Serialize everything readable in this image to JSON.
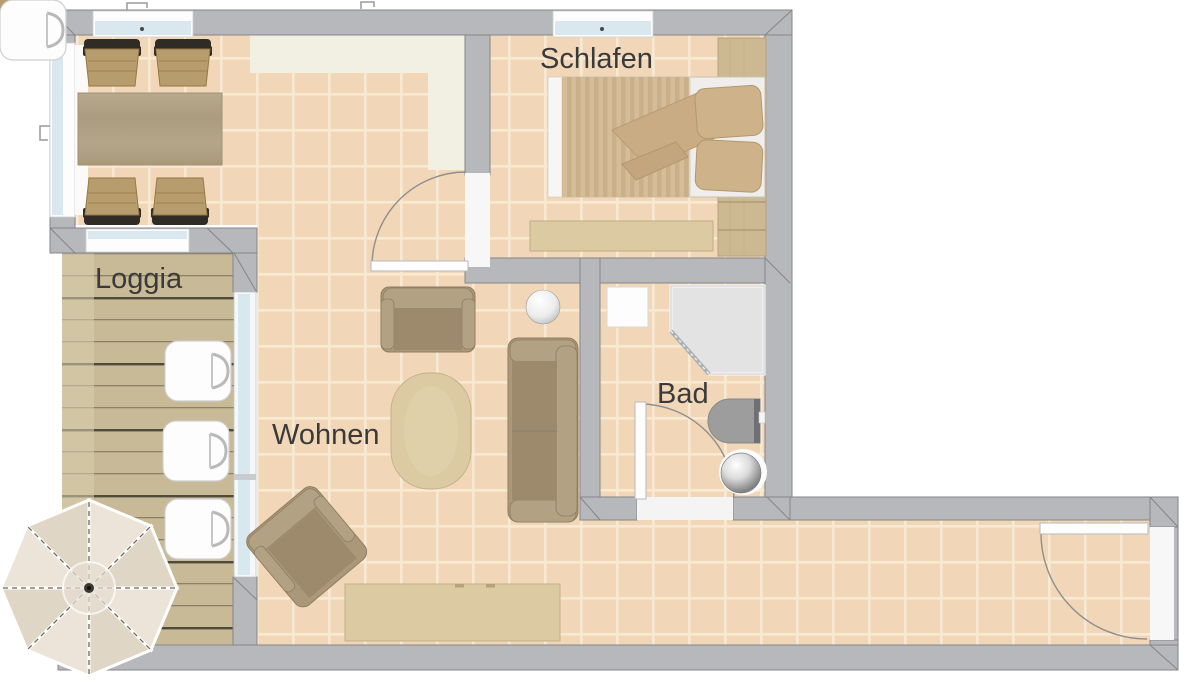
{
  "labels": {
    "bedroom": "Schlafen",
    "loggia": "Loggia",
    "living": "Wohnen",
    "bathroom": "Bad"
  },
  "palette": {
    "outside": "#ffffff",
    "wall": "#b7b8bc",
    "wall_outline": "#84858a",
    "tile": "#f1d7b8",
    "grout": "#f8e9d3",
    "cream_floor": "#f2efe3",
    "deck": "#c8ba97",
    "deck_line_dark": "#4e4a3c",
    "deck_line": "#8d8164",
    "glass": "#d9e8ee",
    "sofa": "#ab9878",
    "sofa_light": "#b3a183",
    "sofa_seat": "#9d8a6d",
    "wood_table": "#b2a387",
    "wood_light": "#dccaa3",
    "wood_mid": "#cdb991",
    "bed_stripe_a": "#d5bd98",
    "bed_stripe_b": "#cab08a",
    "chair_seat": "#b79c6e",
    "chair_frame": "#2f2b25",
    "fixture_gray": "#9d9d9d",
    "shower_fill": "#e3e3e4",
    "text": "#3a3a3a"
  },
  "inventory": [
    "dining-table",
    "dining-chair",
    "double-bed",
    "pillow",
    "duvet",
    "wardrobe",
    "bedroom-sideboard",
    "loveseat",
    "sofa",
    "armchair",
    "coffee-table",
    "tv-lowboard",
    "sphere-lamp",
    "corner-shower",
    "toilet",
    "washbasin",
    "bath-cabinet",
    "deck-chair",
    "parasol",
    "interior-door",
    "entrance-door",
    "window",
    "glass-partition"
  ]
}
